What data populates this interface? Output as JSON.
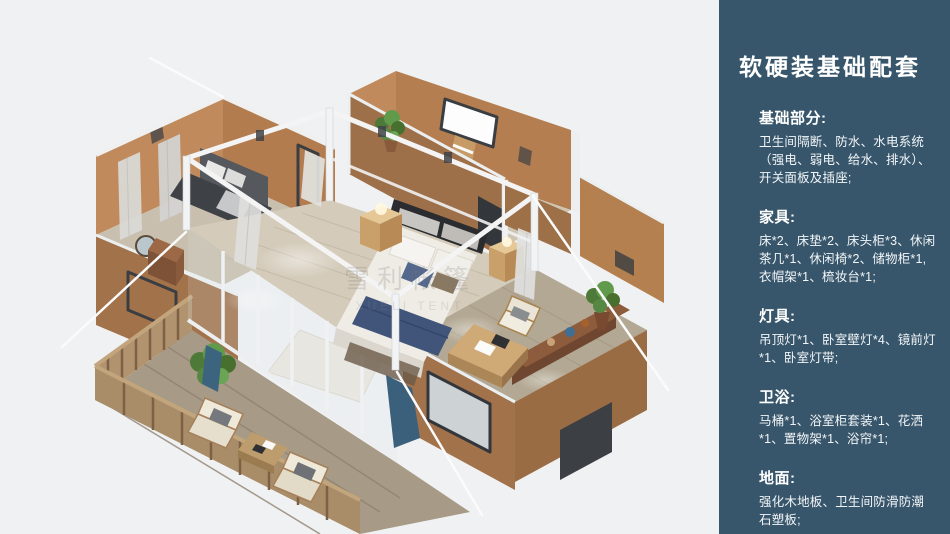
{
  "page": {
    "background": "#f0f1f2"
  },
  "main": {
    "watermark_cn": "雪利帐篷",
    "watermark_en": "XUELI TENT"
  },
  "sidebar": {
    "title": "软硬装基础配套",
    "sections": [
      {
        "heading": "基础部分:",
        "body": "卫生间隔断、防水、水电系统（强电、弱电、给水、排水）、开关面板及插座;"
      },
      {
        "heading": "家具:",
        "body": "床*2、床垫*2、床头柜*3、休闲茶几*1、休闲椅*2、储物柜*1, 衣帽架*1、梳妆台*1;"
      },
      {
        "heading": "灯具:",
        "body": "吊顶灯*1、卧室壁灯*4、镜前灯*1、卧室灯带;"
      },
      {
        "heading": "卫浴:",
        "body": "马桶*1、浴室柜套装*1、花洒*1、置物架*1、浴帘*1;"
      },
      {
        "heading": "地面:",
        "body": "强化木地板、卫生间防滑防潮石塑板;"
      }
    ]
  },
  "palette": {
    "sidebar_bg": "#38566b",
    "canvas_bg": "#f0f1f2",
    "wall_tan": "#b47e50",
    "wall_tan_light": "#c28b5d",
    "wall_tan_dark": "#9e7049",
    "beam_white": "#f2f3f4",
    "floor_wood": "#d4cbba",
    "deck_wood": "#a79a86",
    "rail_wood": "#b1946f",
    "bed_white": "#efece6",
    "bed_runner_navy": "#41547a",
    "curtain_teal": "#3a607c",
    "sofa_gray": "#3f4247",
    "cabinet_brown": "#6f4730",
    "plant_green": "#5d8b46"
  }
}
